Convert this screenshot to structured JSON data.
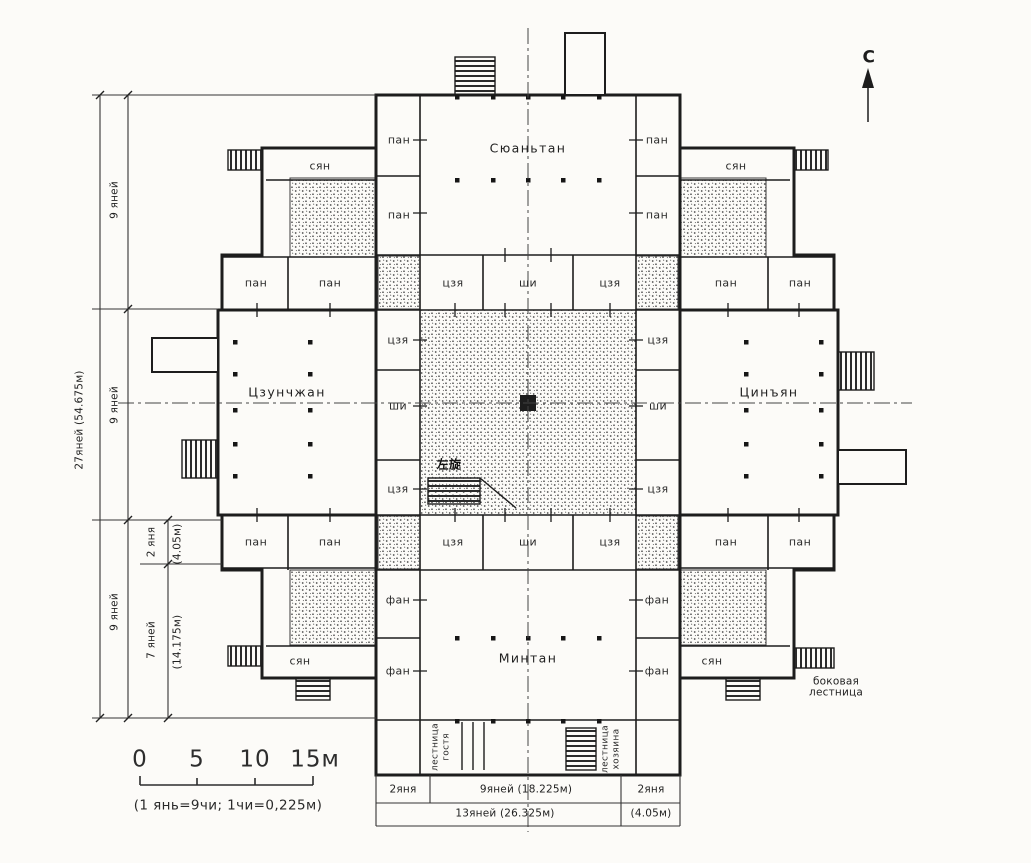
{
  "plan": {
    "north_label": "С",
    "halls": {
      "north": "Сюаньтан",
      "west": "Цзунчжан",
      "east": "Цинъян",
      "south": "Минтан"
    },
    "rooms": {
      "pan": "пан",
      "syan": "сян",
      "jia": "цзя",
      "shi": "ши",
      "fan": "фан"
    },
    "annotations": {
      "left_turn_cn": "左旋",
      "side_stair": "боковая лестница",
      "guest_stair": "лестница гостя",
      "owner_stair": "лестница хозяина"
    },
    "dims": {
      "total_height": "27яней (54.675м)",
      "seg9": "9 яней",
      "seg2": "2 яня",
      "seg2_m": "(4.05м)",
      "seg7": "7 яней",
      "seg7_m": "(14.175м)",
      "bottom_2yan_left": "2яня",
      "bottom_9yan": "9яней (18.225м)",
      "bottom_2yan_right": "2яня",
      "bottom_13yan": "13яней (26.325м)",
      "bottom_4m": "(4.05м)"
    },
    "scale_bar": {
      "t0": "0",
      "t5": "5",
      "t10": "10",
      "t15": "15м",
      "note": "(1 янь=9чи; 1чи=0,225м)"
    }
  }
}
